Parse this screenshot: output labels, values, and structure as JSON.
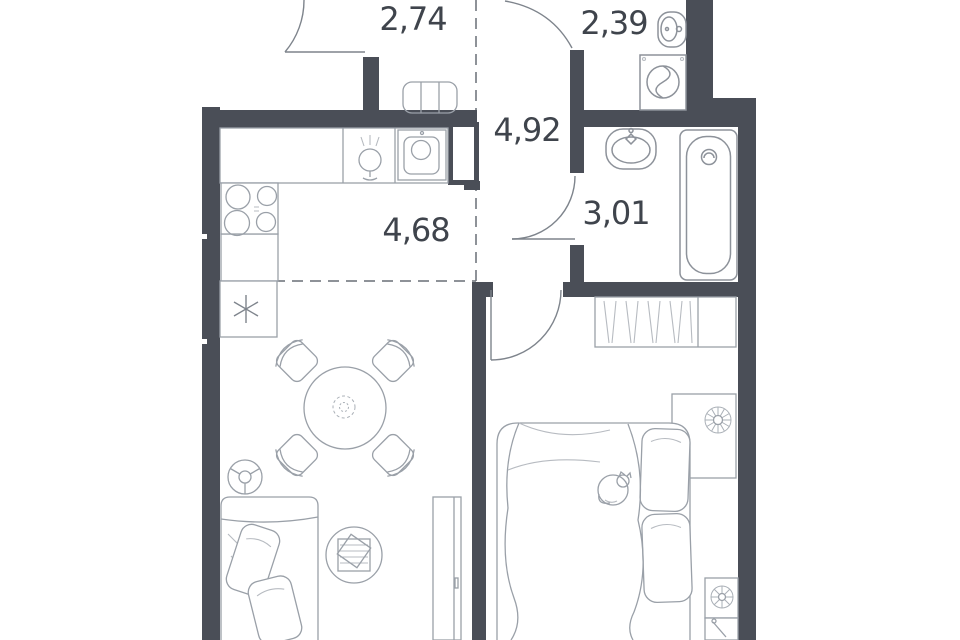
{
  "floor_plan": {
    "title": "apartment-floor-plan",
    "rooms": [
      {
        "name": "loggia",
        "area": "2,74"
      },
      {
        "name": "water-closet",
        "area": "2,39"
      },
      {
        "name": "hallway",
        "area": "4,92"
      },
      {
        "name": "bathroom",
        "area": "3,01"
      },
      {
        "name": "kitchen-living-room",
        "area": "4,68"
      }
    ],
    "colors": {
      "wall": "#4a4e57",
      "furniture_line": "#9aa0a8",
      "fixture_line": "#8d929a",
      "door_line": "#7e848c",
      "zone_dash_line": "#696e76",
      "label_text": "#3f444c",
      "background": "#ffffff"
    },
    "fixtures": [
      "balcony-door",
      "radiator-bench",
      "kitchen-counter",
      "kitchen-faucet",
      "kitchen-sink",
      "vent-shaft",
      "stove",
      "refrigerator-snowflake",
      "dining-table",
      "dining-chair",
      "floor-lamp",
      "sofa",
      "pillows",
      "pouf-tray",
      "tv-console",
      "wash-basin",
      "washing-machine",
      "bathroom-sink",
      "bathtub",
      "wardrobe",
      "double-bed",
      "sleeping-cat",
      "nightstand",
      "plant"
    ]
  }
}
